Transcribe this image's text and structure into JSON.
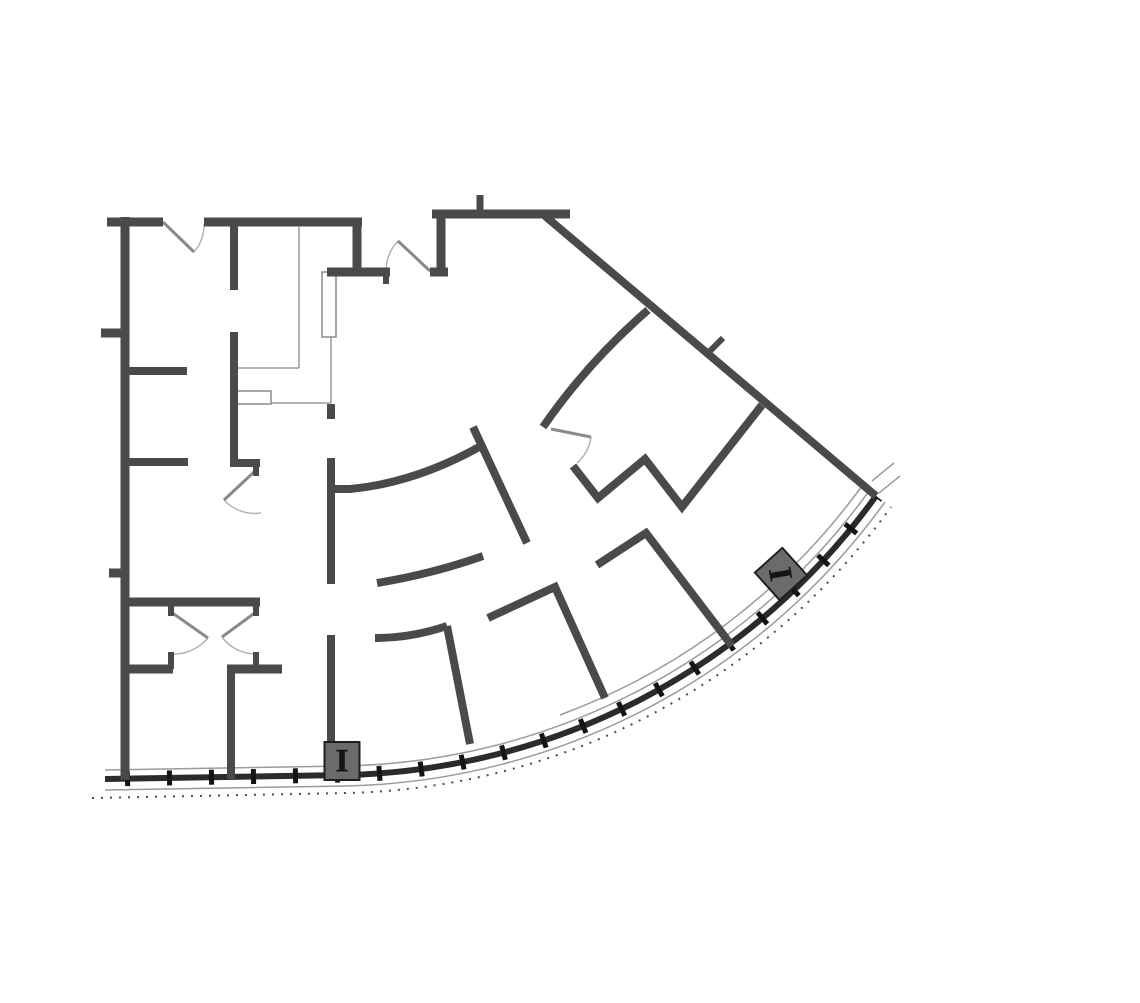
{
  "page": {
    "title": "Curved office building floor plan",
    "width": 1140,
    "height": 1003,
    "background": "#ffffff"
  },
  "style": {
    "colors": {
      "wall": "#4a4a4a",
      "facade_main": "#2b2b2b",
      "mullion_tick": "#141414",
      "thin": "#9b9b9b",
      "speckle": "#4c4c4c",
      "door_leaf": "#8a8a8a",
      "door_swing": "#b4b4b4",
      "counter": "#9b9b9b",
      "fixture_fill": "#ffffff",
      "fixture_stroke": "#8a8a8a",
      "column_fill": "#6b6b6b",
      "column_stroke": "#1f1f1f",
      "column_glyph": "#151515"
    },
    "wall_width": 8,
    "thin_width": 1.5,
    "leaf_width": 3,
    "swing_width": 1.5
  },
  "floorplan": {
    "walls": [
      [
        107,
        222,
        163,
        222,
        9
      ],
      [
        204,
        222,
        362,
        222,
        9
      ],
      [
        125,
        217,
        125,
        780,
        9
      ],
      [
        101,
        333,
        125,
        333,
        9
      ],
      [
        109,
        573,
        125,
        573,
        9
      ],
      [
        125,
        371,
        187,
        371,
        8
      ],
      [
        125,
        462,
        188,
        462,
        8
      ],
      [
        121,
        602,
        260,
        602,
        9
      ],
      [
        171,
        602,
        171,
        616,
        6
      ],
      [
        256,
        602,
        256,
        616,
        6
      ],
      [
        125,
        669,
        173,
        669,
        9
      ],
      [
        171,
        652,
        171,
        669,
        6
      ],
      [
        227,
        669,
        282,
        669,
        9
      ],
      [
        256,
        652,
        256,
        669,
        6
      ],
      [
        231,
        669,
        231,
        779,
        8
      ],
      [
        234,
        222,
        234,
        290,
        8
      ],
      [
        234,
        332,
        234,
        463,
        8
      ],
      [
        230,
        463,
        260,
        463,
        8
      ],
      [
        256,
        463,
        256,
        476,
        6
      ],
      [
        357,
        218,
        357,
        272,
        9
      ],
      [
        327,
        272,
        390,
        272,
        9
      ],
      [
        386,
        272,
        386,
        284,
        6
      ],
      [
        441,
        210,
        441,
        272,
        9
      ],
      [
        430,
        272,
        448,
        272,
        9
      ],
      [
        432,
        214,
        570,
        214,
        9
      ],
      [
        480,
        195,
        480,
        214,
        7
      ],
      [
        545,
        216,
        876,
        496,
        8
      ],
      [
        709,
        352,
        723,
        338,
        6
      ],
      [
        473,
        427,
        527,
        543,
        8
      ],
      [
        331,
        404,
        331,
        419,
        8
      ],
      [
        331,
        458,
        331,
        584,
        8
      ],
      [
        331,
        489,
        351,
        489,
        8
      ],
      [
        331,
        635,
        331,
        744,
        8
      ],
      [
        447,
        626,
        470,
        744,
        8
      ]
    ],
    "polyline_walls": [
      {
        "points": [
          [
            573,
            466
          ],
          [
            598,
            498
          ],
          [
            645,
            459
          ],
          [
            682,
            507
          ],
          [
            762,
            405
          ]
        ],
        "w": 8
      },
      {
        "points": [
          [
            597,
            565
          ],
          [
            646,
            533
          ],
          [
            732,
            646
          ]
        ],
        "w": 8
      },
      {
        "points": [
          [
            488,
            618
          ],
          [
            555,
            587
          ],
          [
            605,
            698
          ]
        ],
        "w": 8
      }
    ],
    "curved_walls": [
      {
        "d": "M350,489 Q415,483 481,446",
        "w": 8
      },
      {
        "d": "M377,583 Q432,574 483,556",
        "w": 8
      },
      {
        "d": "M375,638 Q411,638 447,626",
        "w": 8
      },
      {
        "d": "M648,310 Q588,362 543,427",
        "w": 8
      }
    ],
    "doors": [
      {
        "leaf": [
          163,
          222,
          194,
          252
        ],
        "arc": "M194,252 A42,42 0 0 0 204,224"
      },
      {
        "leaf": [
          430,
          271,
          398,
          241
        ],
        "arc": "M398,241 A44,44 0 0 0 386,271"
      },
      {
        "leaf": [
          254,
          472,
          224,
          500
        ],
        "arc": "M224,500 A42,42 0 0 0 261,513"
      },
      {
        "leaf": [
          171,
          612,
          208,
          638
        ],
        "arc": "M208,638 A45,45 0 0 1 172,654"
      },
      {
        "leaf": [
          256,
          612,
          222,
          637
        ],
        "arc": "M222,637 A42,42 0 0 0 256,654"
      },
      {
        "leaf": [
          551,
          429,
          591,
          437
        ],
        "arc": "M591,437 A42,42 0 0 1 577,463"
      }
    ],
    "casework": {
      "lines": [
        [
          299,
          227,
          299,
          368
        ],
        [
          237,
          368,
          299,
          368
        ],
        [
          271,
          403,
          331,
          403
        ],
        [
          331,
          277,
          331,
          403
        ]
      ],
      "fixtures": [
        [
          237,
          391,
          34,
          13
        ],
        [
          322,
          272,
          14,
          65
        ]
      ]
    },
    "facade": {
      "layers": [
        {
          "name": "facade-glass-line-inner",
          "d": "M105,770 L344,766 A663,663 0 0 0 869,491",
          "w": 1.5,
          "color": "thin"
        },
        {
          "name": "facade-glass-line-inner2",
          "d": "M560,715 A655,655 0 0 0 862,486",
          "w": 1.5,
          "color": "thin"
        },
        {
          "name": "facade-glass-line-outer",
          "d": "M105,790 L346,786 A683,683 0 0 0 885,502",
          "w": 1.5,
          "color": "thin"
        },
        {
          "name": "facade-speckle-line",
          "d": "M92,798 L347,793 A691,691 0 0 0 891,507",
          "w": 2,
          "color": "speckle",
          "dash": "2 7"
        },
        {
          "name": "facade-main-wall",
          "d": "M105,779 L345,775 A672,672 0 0 0 876,496",
          "w": 6,
          "color": "facade_main"
        },
        {
          "name": "facade-mullion-ticks",
          "d": "M105,779 L345,775 A672,672 0 0 0 876,496",
          "w": 15,
          "color": "mullion_tick",
          "dash": "5 37",
          "dashoffset": 22
        },
        {
          "name": "facade-corner-extension1",
          "d": "M872,481 L894,463",
          "w": 1.5,
          "color": "thin"
        },
        {
          "name": "facade-corner-extension2",
          "d": "M879,493 L900,476",
          "w": 1.5,
          "color": "thin"
        }
      ]
    },
    "columns": [
      {
        "cx": 342,
        "cy": 761,
        "w": 35,
        "h": 38,
        "rot": 0,
        "label_rot": 0,
        "label": "I"
      },
      {
        "cx": 781,
        "cy": 574,
        "w": 37,
        "h": 37,
        "rot": -42,
        "label_rot": -100,
        "label": "I"
      }
    ]
  }
}
